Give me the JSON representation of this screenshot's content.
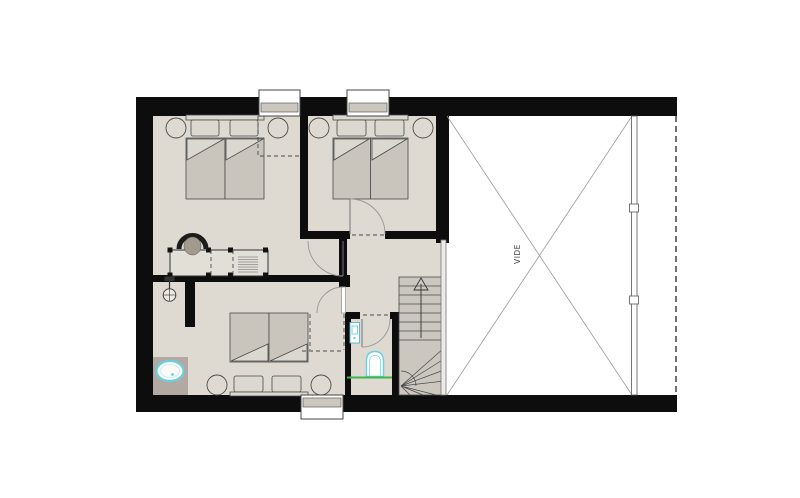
{
  "labels": {
    "void": "VIDE"
  },
  "palette": {
    "wall": "#0d0d0d",
    "floor": "#dedad2",
    "counter": "#b2aaa2",
    "bed": "#c9c5bc",
    "bed_light": "#dbd8cf",
    "stair": "#cbc7bf",
    "line": "#4a4a4a",
    "door_line": "#979797",
    "window_sill": "#ccc8c0",
    "void_line": "#9a9a9a",
    "cyan": "#6ccfdd",
    "green": "#3cb54a"
  }
}
